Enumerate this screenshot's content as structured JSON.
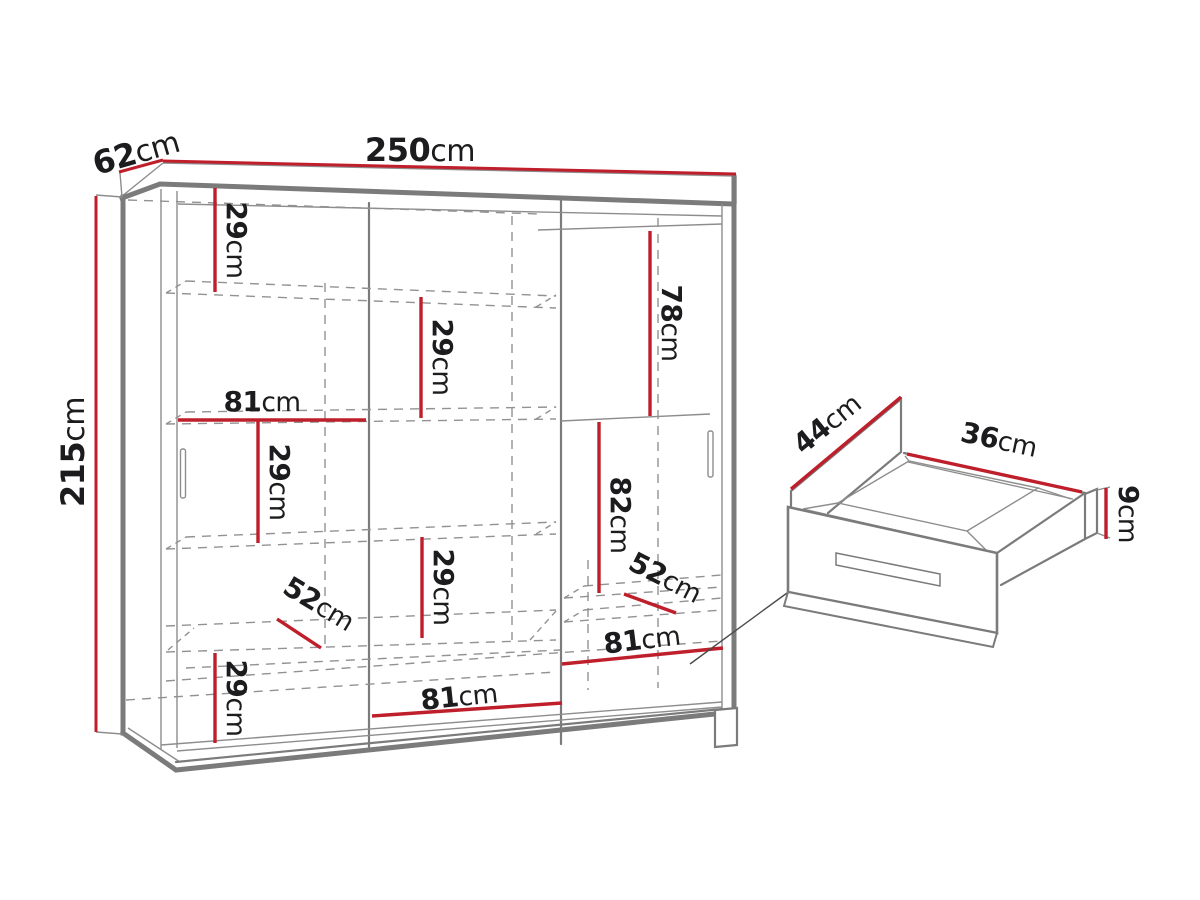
{
  "diagram": {
    "unit": "cm",
    "colors": {
      "dimension_red": "#bf1e2b",
      "line_gray": "#7b7b7b",
      "dash_gray": "#929292",
      "text": "#1c1c1e"
    },
    "wardrobe": {
      "width": {
        "num": "250",
        "unit": "cm"
      },
      "depth": {
        "num": "62",
        "unit": "cm"
      },
      "height": {
        "num": "215",
        "unit": "cm"
      },
      "sections": {
        "top_left_gap": {
          "num": "29",
          "unit": "cm"
        },
        "middle_upper_gap": {
          "num": "29",
          "unit": "cm"
        },
        "right_upper_height": {
          "num": "78",
          "unit": "cm"
        },
        "left_width": {
          "num": "81",
          "unit": "cm"
        },
        "left_middle_gap": {
          "num": "29",
          "unit": "cm"
        },
        "right_middle_height": {
          "num": "82",
          "unit": "cm"
        },
        "middle_lower_gap": {
          "num": "29",
          "unit": "cm"
        },
        "left_depth": {
          "num": "52",
          "unit": "cm"
        },
        "right_depth": {
          "num": "52",
          "unit": "cm"
        },
        "right_width": {
          "num": "81",
          "unit": "cm"
        },
        "middle_width": {
          "num": "81",
          "unit": "cm"
        },
        "bottom_left_gap": {
          "num": "29",
          "unit": "cm"
        }
      }
    },
    "drawer": {
      "depth": {
        "num": "44",
        "unit": "cm"
      },
      "width": {
        "num": "36",
        "unit": "cm"
      },
      "height": {
        "num": "9",
        "unit": "cm"
      }
    }
  }
}
